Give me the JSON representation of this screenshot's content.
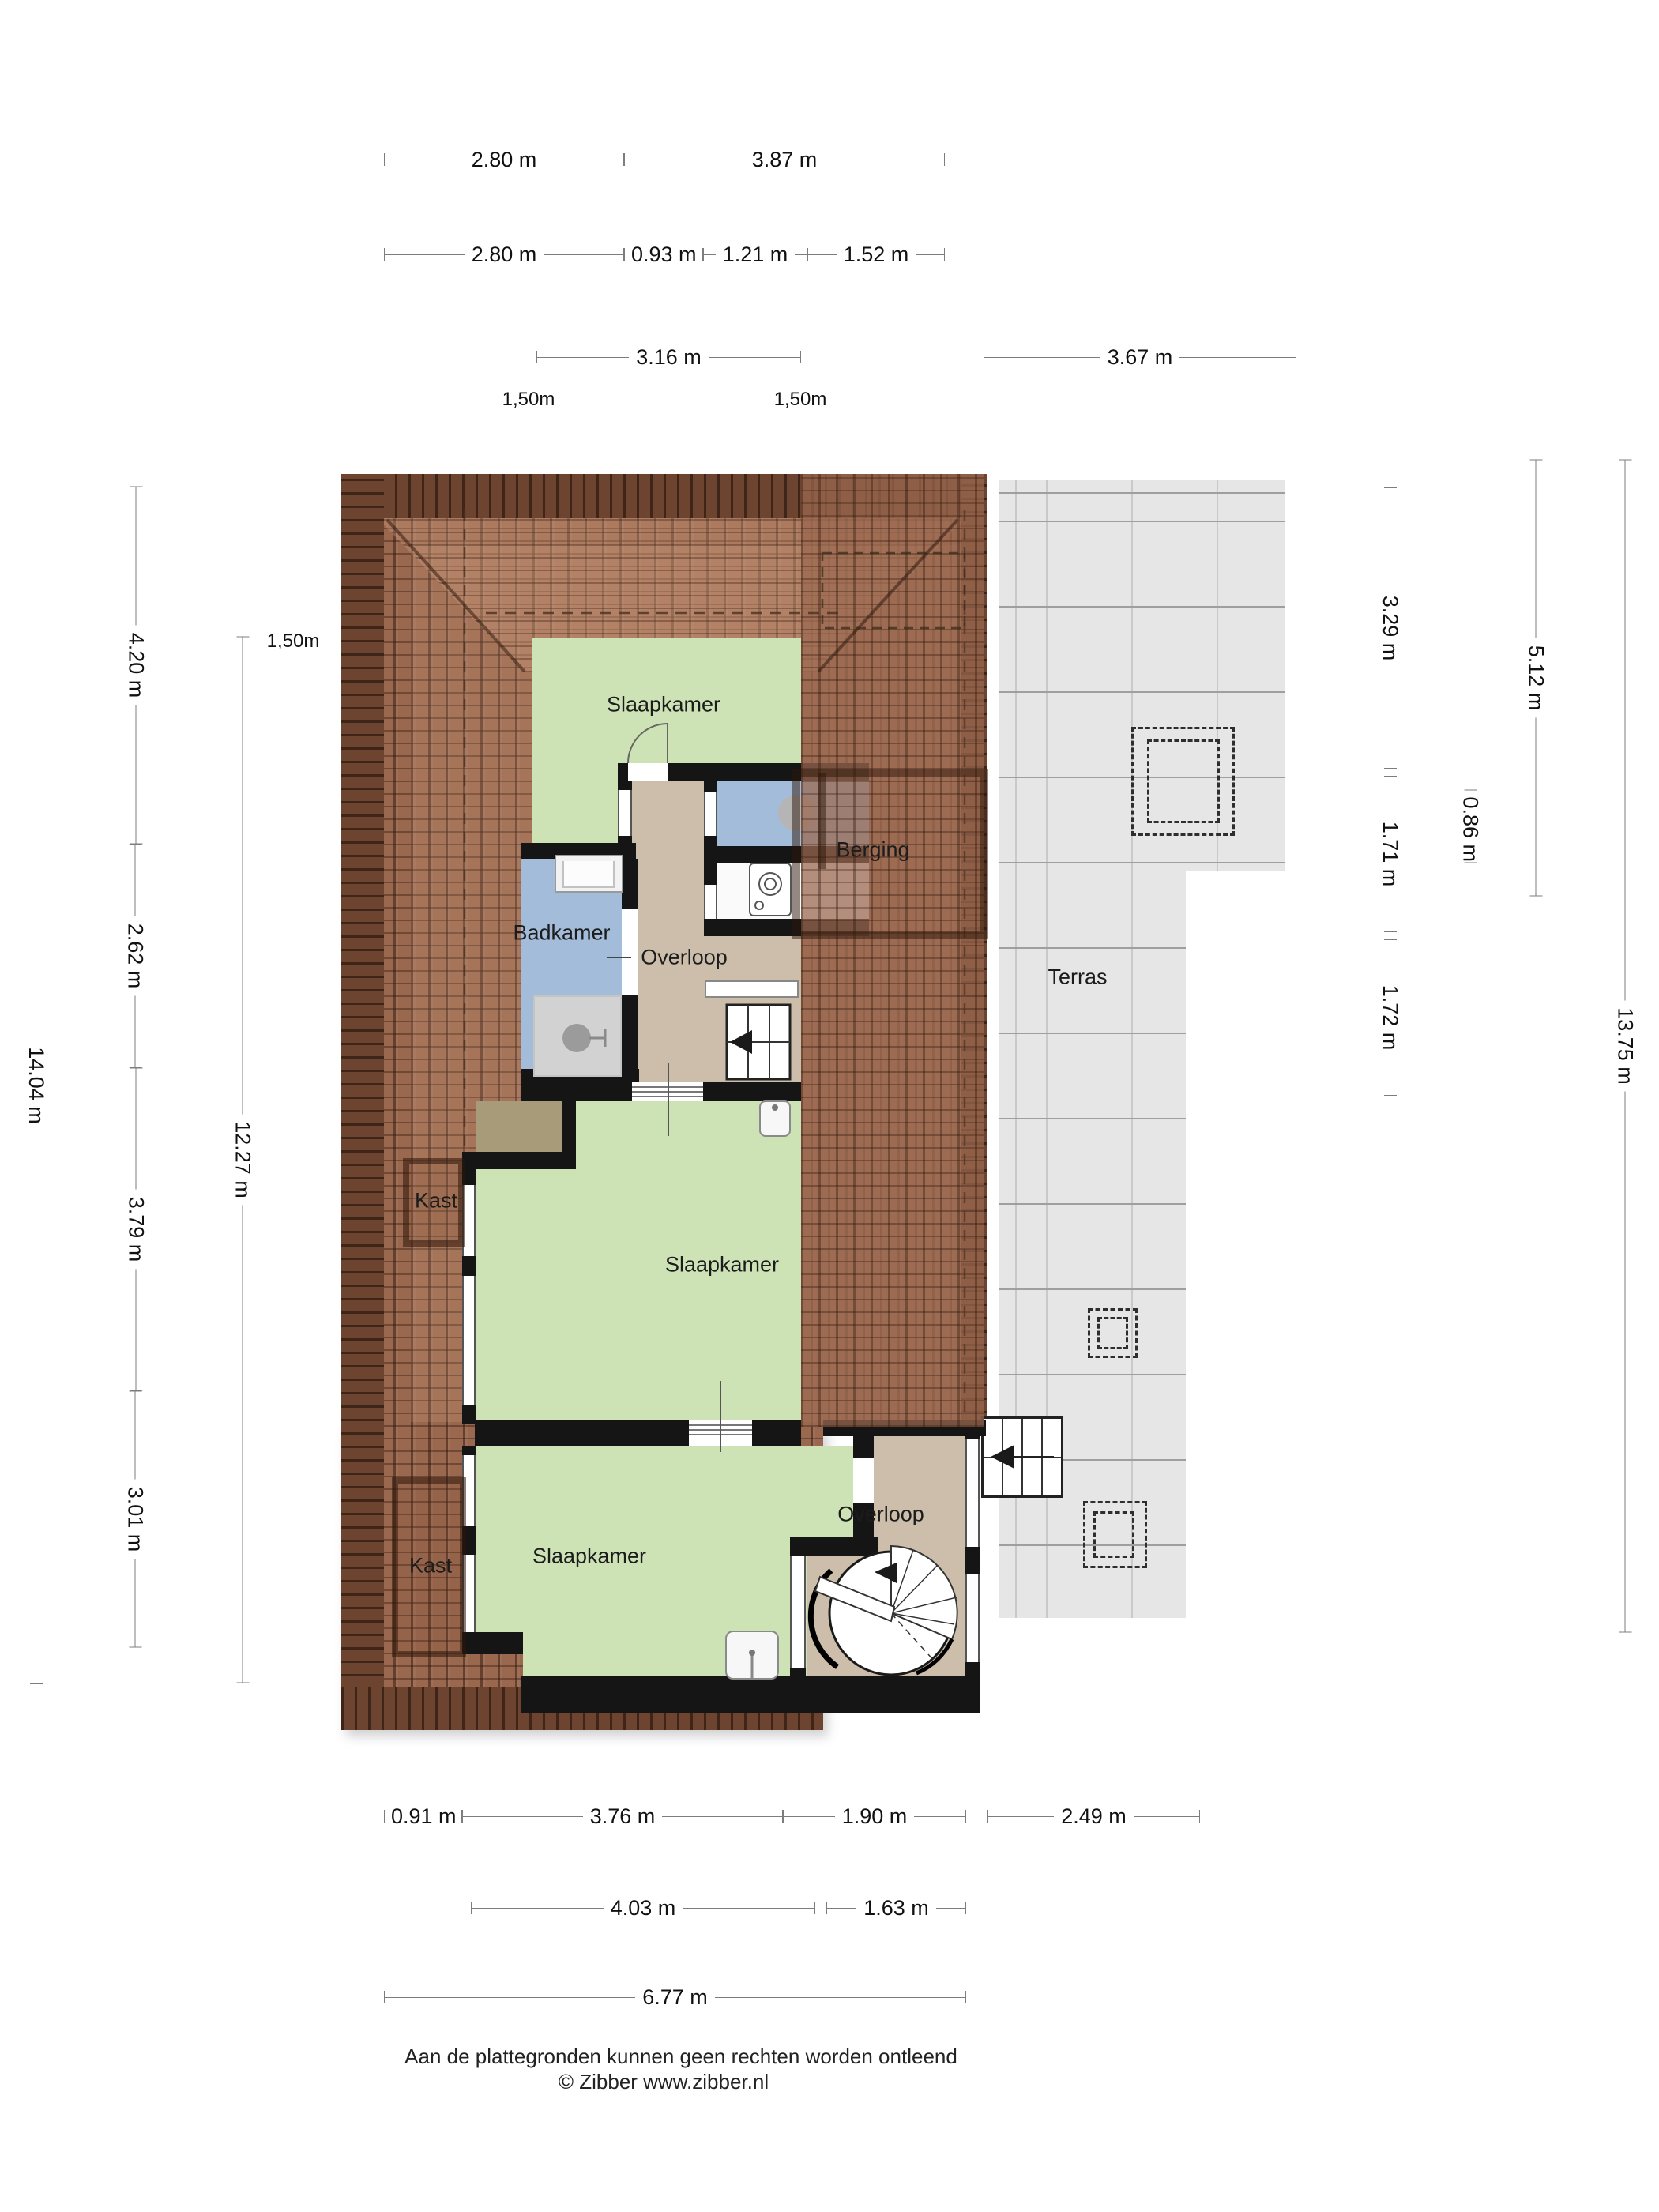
{
  "rooms": {
    "slaapkamer_top": "Slaapkamer",
    "berging": "Berging",
    "badkamer": "Badkamer",
    "overloop_mid": "Overloop",
    "slaapkamer_mid": "Slaapkamer",
    "kast_upper": "Kast",
    "slaapkamer_bottom": "Slaapkamer",
    "kast_lower": "Kast",
    "overloop_bottom": "Overloop",
    "terras": "Terras"
  },
  "dims": {
    "t1a": "2.80 m",
    "t1b": "3.87 m",
    "t2a": "2.80 m",
    "t2b": "0.93 m",
    "t2c": "1.21 m",
    "t2d": "1.52 m",
    "t3a": "3.16 m",
    "t3b": "3.67 m",
    "clearance_top_left": "1,50m",
    "clearance_top_right": "1,50m",
    "clearance_left": "1,50m",
    "l1": "14.04 m",
    "l2a": "4.20 m",
    "l2b": "2.62 m",
    "l2c": "3.79 m",
    "l2d": "3.01 m",
    "l3": "12.27 m",
    "r1a": "3.29 m",
    "r1b": "1.71 m",
    "r1c": "1.72 m",
    "r2": "0.86 m",
    "r3": "5.12 m",
    "r4": "13.75 m",
    "b1a": "0.91 m",
    "b1b": "3.76 m",
    "b1c": "1.90 m",
    "b1d": "2.49 m",
    "b2a": "4.03 m",
    "b2b": "1.63 m",
    "b3": "6.77 m"
  },
  "footer": {
    "line1": "Aan de plattegronden kunnen geen rechten worden ontleend",
    "line2": "© Zibber www.zibber.nl"
  },
  "colors": {
    "roof": "#9a684f",
    "roof_ridge": "#6d4430",
    "bedroom_green": "#cde3b5",
    "bathroom_blue": "#a3bcd9",
    "landing_tan": "#ccbeaa",
    "terrace_gray": "#e6e6e6",
    "wall": "#151515"
  }
}
